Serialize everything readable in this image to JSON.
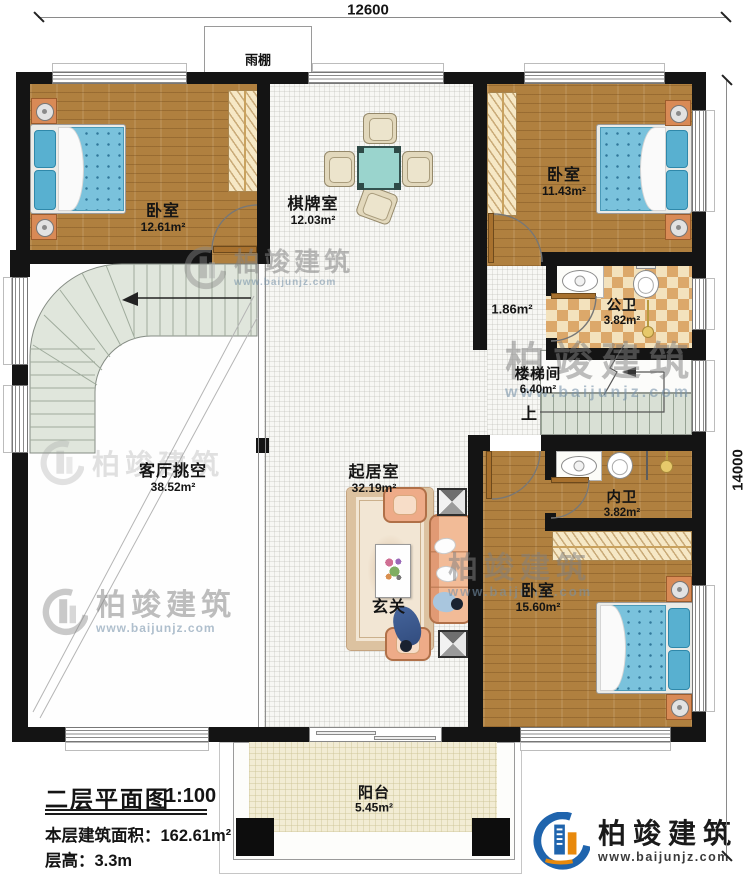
{
  "dimensions": {
    "width_mm": "12600",
    "height_mm": "14000"
  },
  "rooms": {
    "bedroom_tl": {
      "name": "卧室",
      "area": "12.61m²"
    },
    "game_room": {
      "name": "棋牌室",
      "area": "12.03m²"
    },
    "bedroom_tr": {
      "name": "卧室",
      "area": "11.43m²"
    },
    "corridor": {
      "area": "1.86m²"
    },
    "public_bath": {
      "name": "公卫",
      "area": "3.82m²"
    },
    "stairwell": {
      "name": "楼梯间",
      "area": "6.40m²"
    },
    "living_void": {
      "name": "客厅挑空",
      "area": "38.52m²"
    },
    "living_room": {
      "name": "起居室",
      "area": "32.19m²"
    },
    "private_bath": {
      "name": "内卫",
      "area": "3.82m²"
    },
    "bedroom_br": {
      "name": "卧室",
      "area": "15.60m²"
    },
    "balcony": {
      "name": "阳台",
      "area": "5.45m²"
    }
  },
  "annotations": {
    "canopy": "雨棚",
    "up": "上",
    "foyer": "玄关"
  },
  "title_block": {
    "title": "二层平面图",
    "scale": "1:100",
    "floor_area": "本层建筑面积：162.61m²",
    "floor_height": "层高：3.3m"
  },
  "brand": {
    "name": "柏竣建筑",
    "website": "www.baijunjz.com"
  },
  "colors": {
    "wall": "#141414",
    "wood_floor": "#b0803f",
    "bath_tile": "#dca86a",
    "stair": "#dde4da",
    "bed": "#7ac2dc",
    "brand_blue": "#1f64ad",
    "brand_orange": "#e8890c"
  }
}
